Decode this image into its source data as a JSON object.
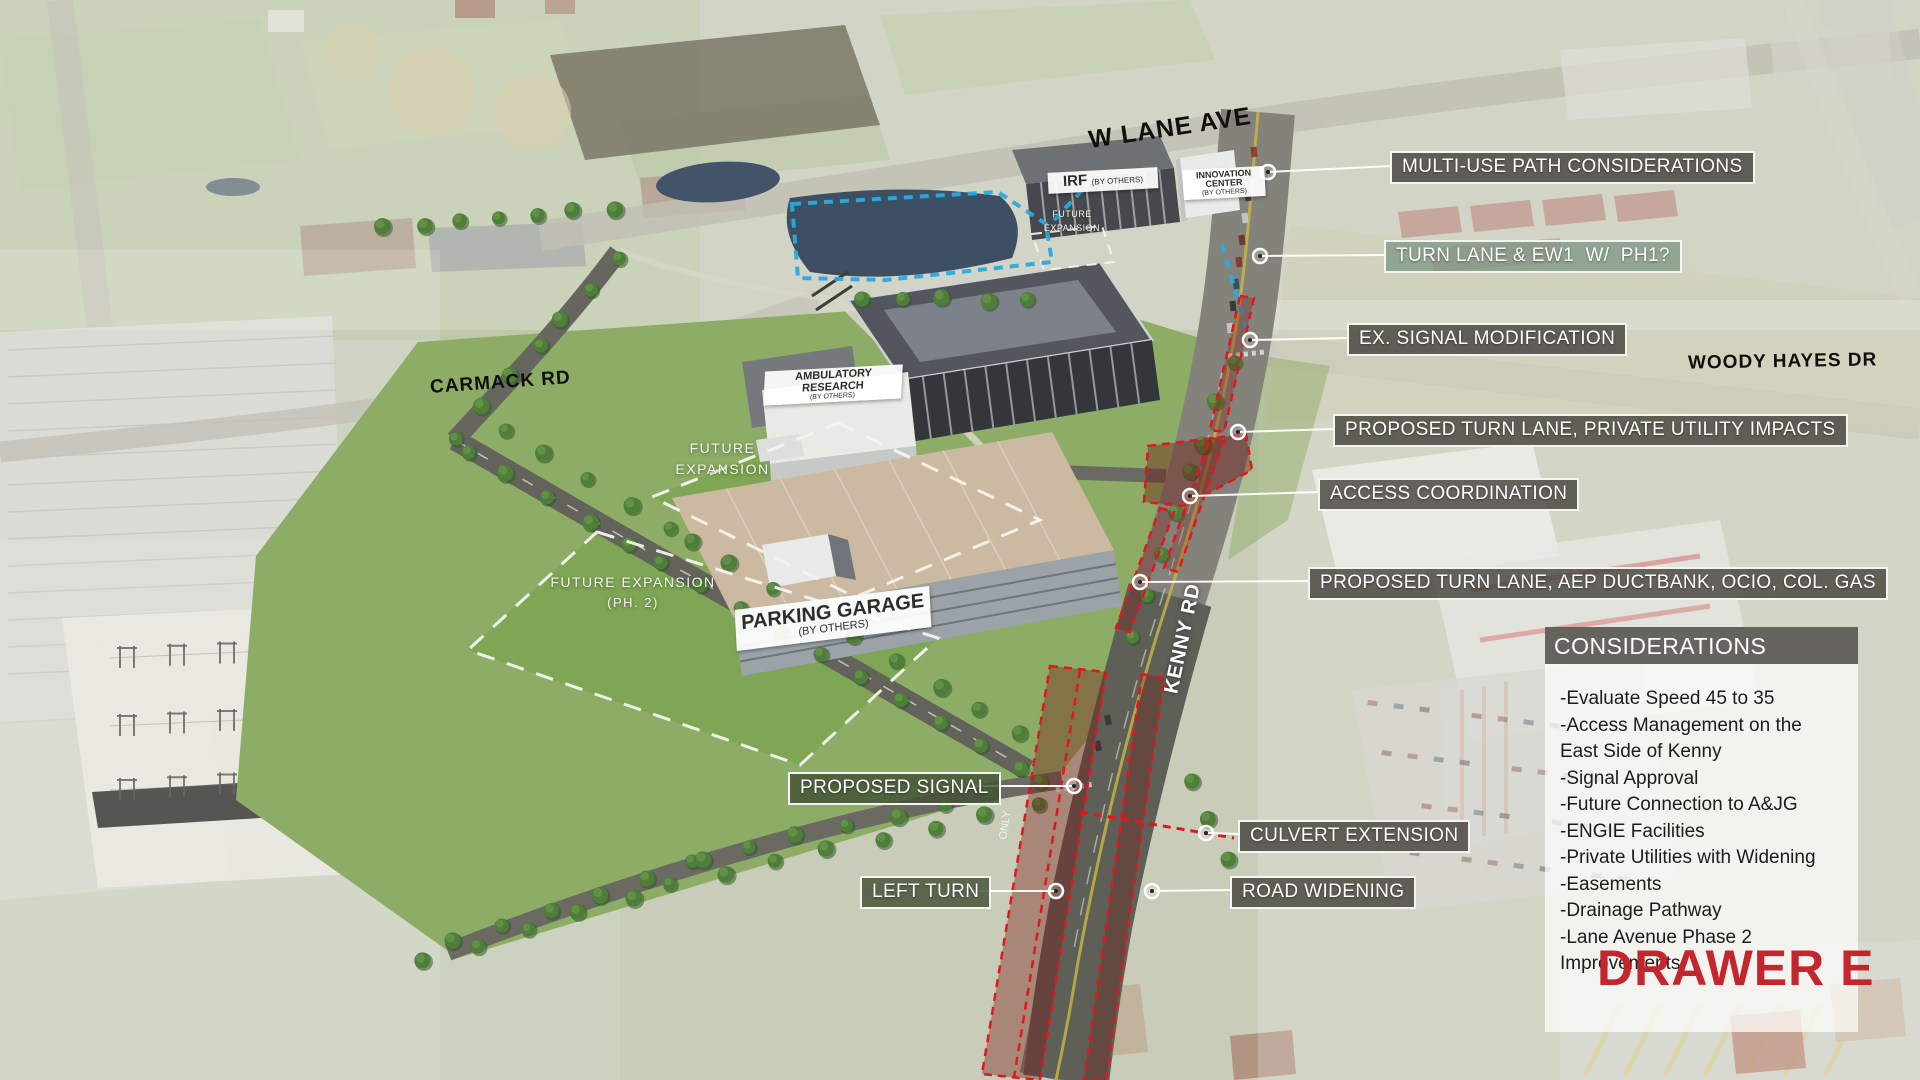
{
  "colors": {
    "accent_red": "#c4262e",
    "overlay_red": "#e3161c",
    "overlay_blue": "#2ba9e0",
    "callout_background": "#494740",
    "turn_lane_callout_background": "#7d9885"
  },
  "road_labels": {
    "w_lane": "W LANE AVE",
    "carmack": "CARMACK RD",
    "woody_hayes": "WOODY HAYES DR",
    "kenny": "KENNY RD"
  },
  "road_markings": {
    "only": "ONLY"
  },
  "building_labels": {
    "irf": {
      "title": "IRF",
      "subtitle": "(BY OTHERS)"
    },
    "innovation": {
      "line1": "INNOVATION",
      "line2": "CENTER",
      "subtitle": "(BY OTHERS)"
    },
    "ambulatory": {
      "title": "AMBULATORY RESEARCH",
      "subtitle": "(BY OTHERS)"
    },
    "garage": {
      "title": "PARKING GARAGE",
      "subtitle": "(BY OTHERS)"
    }
  },
  "area_labels": {
    "future_expansion_irf": {
      "line1": "FUTURE",
      "line2": "EXPANSION"
    },
    "future_expansion_center": {
      "line1": "FUTURE",
      "line2": "EXPANSION"
    },
    "future_expansion_ph2": {
      "line1": "FUTURE EXPANSION",
      "line2": "(PH. 2)"
    }
  },
  "callouts": {
    "multi_use": "MULTI-USE PATH CONSIDERATIONS",
    "turn_lane_ew1": "TURN LANE & EW1  W/  PH1?",
    "ex_signal": "EX. SIGNAL MODIFICATION",
    "turn_lane_private": "PROPOSED TURN LANE, PRIVATE UTILITY IMPACTS",
    "access": "ACCESS COORDINATION",
    "turn_lane_aep": "PROPOSED TURN LANE, AEP DUCTBANK, OCIO, COL. GAS",
    "proposed_signal": "PROPOSED SIGNAL",
    "culvert": "CULVERT EXTENSION",
    "left_turn": "LEFT TURN",
    "road_widening": "ROAD WIDENING"
  },
  "considerations": {
    "header": "CONSIDERATIONS",
    "items": [
      "-Evaluate Speed 45 to 35",
      "-Access Management on the",
      "East Side of Kenny",
      "-Signal Approval",
      "-Future Connection to A&JG",
      "-ENGIE Facilities",
      "-Private Utilities with Widening",
      "-Easements",
      "-Drainage Pathway",
      "-Lane Avenue Phase 2 Improvements"
    ]
  },
  "drawer_label": "DRAWER E"
}
